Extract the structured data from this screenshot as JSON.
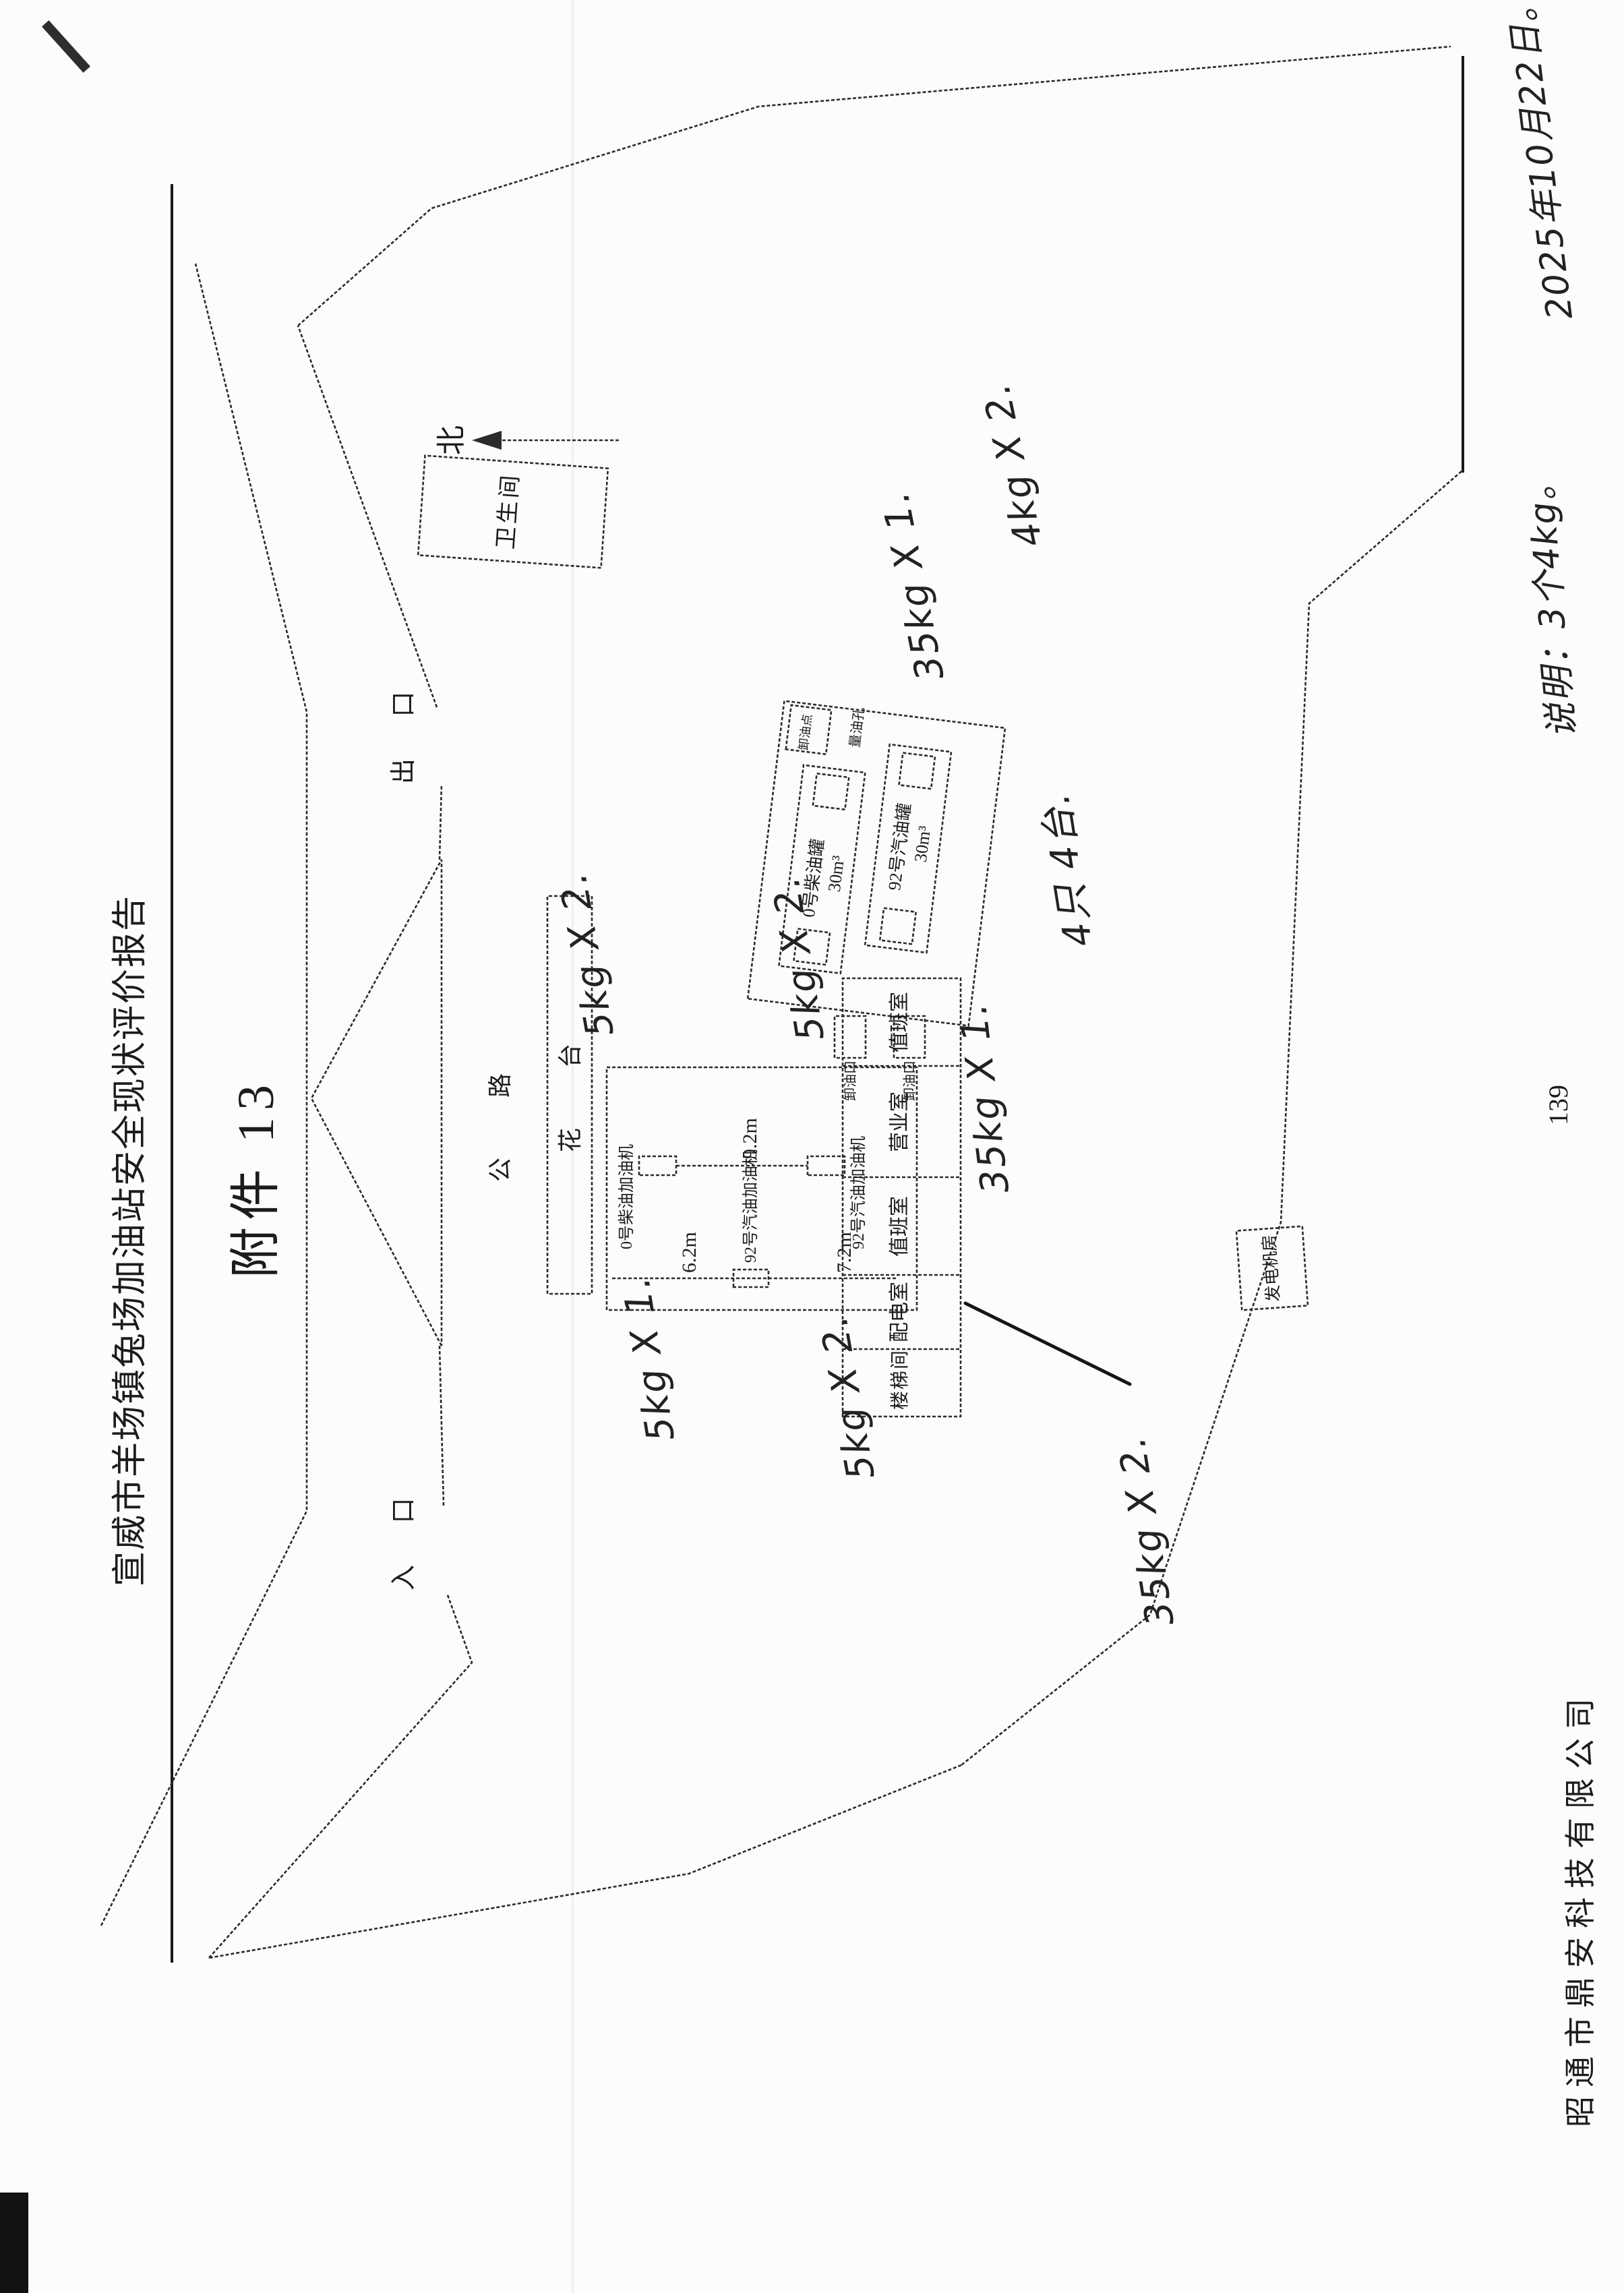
{
  "page": {
    "title": "宣威市羊场镇兔场加油站安全现状评价报告",
    "attachment_label": "附件 13",
    "page_number": "139",
    "company": "昭通市鼎安科技有限公司"
  },
  "plan": {
    "north": "北",
    "toilet": "卫生间",
    "exit": "出 口",
    "entrance": "入 口",
    "road": "公 路",
    "flower_bed": "花 台",
    "rooms": [
      "楼梯间",
      "配电室",
      "值班室",
      "营业室",
      "值班室"
    ],
    "dispenser_diesel": "0号柴油加油机",
    "dispenser_gasoline": "92号汽油加油机",
    "dim_a": "6.2m",
    "dim_b": "7.2m",
    "dim_c": "9.2m",
    "tank_diesel": "0号柴油罐",
    "tank_diesel_volume": "30m³",
    "tank_gasoline": "92号汽油罐",
    "tank_gasoline_volume": "30m³",
    "oil_gauge_well": "量油孔",
    "unloading_port": "卸油口",
    "unloading_point": "卸油点",
    "generator_room": "发电机房"
  },
  "handwriting": {
    "ext_5kg_x2_a": "5kg X 2.",
    "ext_5kg_x2_b": "5kg X 2.",
    "ext_5kg_x1": "5kg X 1.",
    "ext_5kg_x2_c": "5kg X 2.",
    "ext_35kg_x1_a": "35kg X 1.",
    "ext_35kg_x1_b": "35kg X 1.",
    "ext_4kg_x2": "4kg X 2.",
    "count_note": "4只 4台.",
    "ext_35kg_x2": "35kg X 2.",
    "summary_note": "说明：3个4kg。",
    "date_note": "2025年10月22日。"
  }
}
